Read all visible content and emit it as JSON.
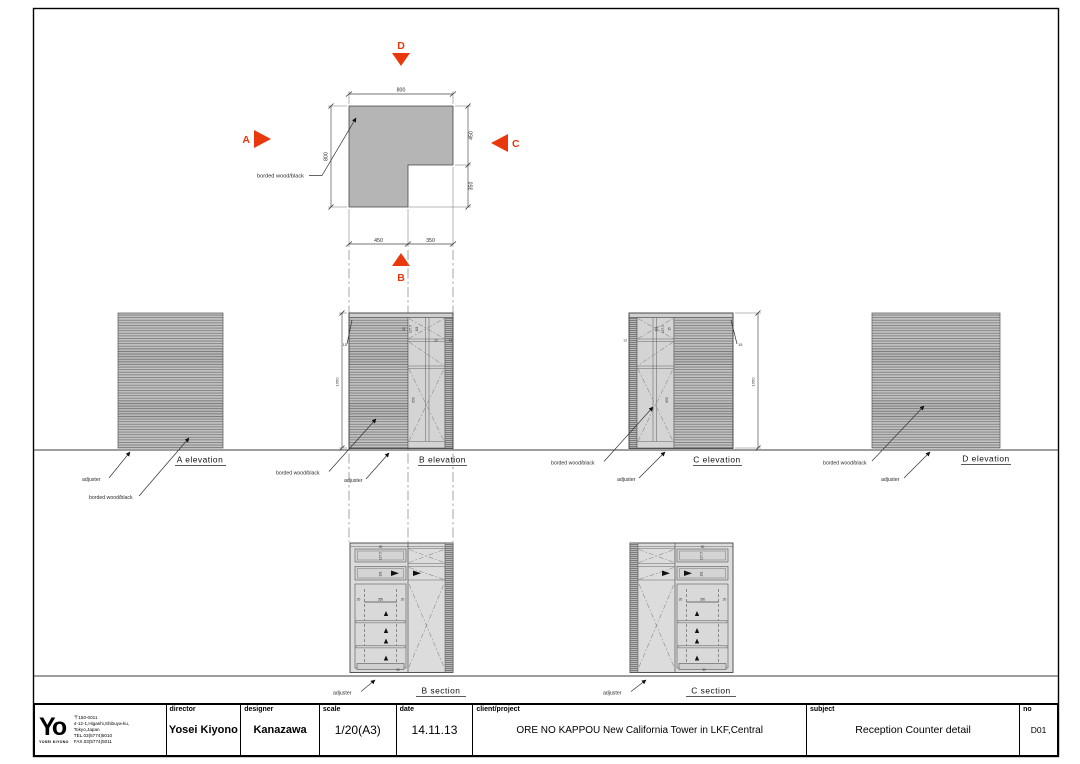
{
  "colors": {
    "arrow_red": "#e8380c",
    "plan_fill": "#b5b5b5"
  },
  "plan": {
    "arrows": {
      "a": "A",
      "b": "B",
      "c": "C",
      "d": "D"
    },
    "dims": {
      "top": "800",
      "left": "800",
      "right_upper": "450",
      "right_lower": "350",
      "bottom_left": "450",
      "bottom_right": "350"
    },
    "material_label": "borded wood/black"
  },
  "elev_a": {
    "title": "A elevation",
    "adjuster": "adjuster",
    "material": "borded wood/black"
  },
  "elev_b": {
    "title": "B elevation",
    "adjuster": "adjuster",
    "material": "borded wood/black",
    "dims": {
      "height": "1050",
      "top": "15",
      "inner": "650",
      "a": "15",
      "b": "127.5",
      "c": "101",
      "d": "20",
      "e": "13"
    }
  },
  "elev_c": {
    "title": "C elevation",
    "adjuster": "adjuster",
    "material": "borded wood/black",
    "dims": {
      "height": "1050",
      "top": "15",
      "inner": "650",
      "a": "15",
      "b": "127.5",
      "c": "101",
      "e": "13"
    }
  },
  "elev_d": {
    "title": "D elevation",
    "adjuster": "adjuster",
    "material": "borded wood/black"
  },
  "sec_b": {
    "title": "B section",
    "adjuster": "adjuster",
    "dims": {
      "top": "30",
      "drawer": "127.5",
      "shelf": "101",
      "width": "350",
      "side": "20",
      "base": "30"
    }
  },
  "sec_c": {
    "title": "C section",
    "adjuster": "adjuster",
    "dims": {
      "top": "30",
      "drawer": "127.5",
      "shelf": "101",
      "width": "350",
      "side": "20",
      "base": "30"
    }
  },
  "title_block": {
    "logo_mark": "Yo",
    "logo_sub": "YOSEI KIYONO",
    "address": [
      "〒150-0011",
      "4-12-1,Higashi,Shibuya-ku,",
      "Tokyo,Japan",
      "TEL.03(5774)5010",
      "FAX.03(5774)5011"
    ],
    "director_label": "director",
    "director": "Yosei Kiyono",
    "designer_label": "designer",
    "designer": "Kanazawa",
    "scale_label": "scale",
    "scale": "1/20(A3)",
    "date_label": "date",
    "date": "14.11.13",
    "client_label": "client/project",
    "client": "ORE NO KAPPOU New California Tower in LKF,Central",
    "subject_label": "subject",
    "subject": "Reception Counter detail",
    "no_label": "no",
    "no": "D01"
  }
}
